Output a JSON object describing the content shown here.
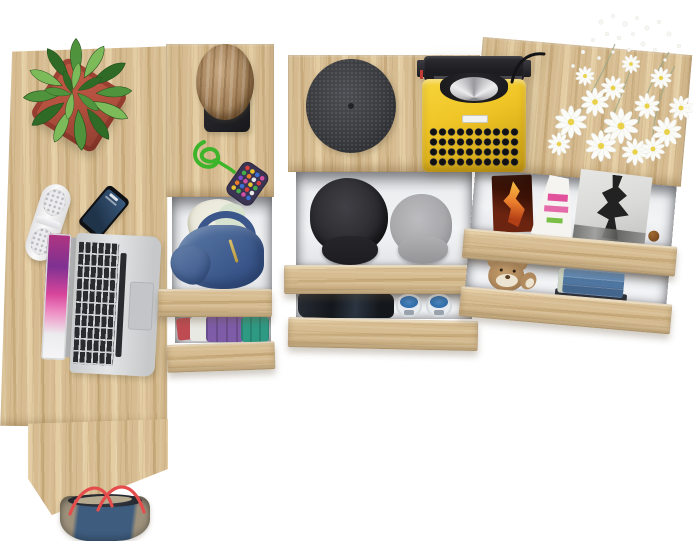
{
  "image_type": "Product photo — top-down view of a light-oak desk and three drawer chests with open drawers, staged with objects, on a white background",
  "background": "#ffffff",
  "colors": {
    "wood": "#d6bc90",
    "wood_light": "#e4cda3",
    "wood_dark": "#c8ab7c",
    "pot": "#b5523f",
    "pot_dark": "#8e3d2f",
    "leaf_dark": "#2f6a27",
    "leaf_mid": "#4f943c",
    "leaf_light": "#7cba5a",
    "cork": "#aa8154",
    "stand_black": "#232327",
    "cord_green": "#3eb42b",
    "pouch_base": "#3a3452",
    "flatcap": "#404146",
    "cap_black": "#2b2b2f",
    "cap_black_brim": "#1d1d21",
    "cap_gray": "#a9a9ac",
    "cap_gray_brim": "#949497",
    "tw_yellow": "#efc526",
    "tw_yellow_dark": "#c99f14",
    "tw_black": "#1d1d21",
    "laptop_key": "#2a2b2e",
    "screen_pink": "#d8459b",
    "screen_purple": "#7e3192",
    "screen_pink_light": "#ee8cc3",
    "phone_body": "#0e1014",
    "phone_screen_a": "#3a5a7e",
    "phone_screen_b": "#1f3349",
    "speaker_dot": "#b9babe",
    "hoodie_a": "#5b7aa6",
    "hoodie_b": "#3a568a",
    "shirt_cream": "#ebe9db",
    "shirt_mint": "#d7e3cf",
    "cl_purple": "#7e5ca8",
    "cl_teal": "#2f9a84",
    "cl_red": "#bf4b52",
    "cl_white": "#e9e9e3",
    "dark_cloth_a": "#272c34",
    "dark_cloth_b": "#14171c",
    "shoe_blue": "#2e6ba9",
    "shoe_white": "#e7eaee",
    "shoe_gray": "#9aa2ab",
    "fire_dark": "#3c1206",
    "fire_orange": "#ec7f2e",
    "fire_yellow": "#f6c344",
    "mag_white": "#f5f4f0",
    "mag_pink": "#e2519c",
    "mag_green": "#7abf45",
    "bw_bg": "#dadad8",
    "bw_fig": "#222222",
    "teddy": "#b18a5d",
    "teddy_cream": "#ece4d0",
    "jeans_a": "#6189b4",
    "jeans_b": "#44658c",
    "jeans_band": "#ccd3c3",
    "jeans_under": "#2e3138",
    "bag_denim": "#3e5c7e",
    "bag_taupe": "#9d917c",
    "bag_strap": "#e44d4c",
    "bag_inner": "#23262d",
    "bag_flap": "#b5aa8f",
    "daisy_white": "#fbfbf8",
    "daisy_center": "#e9d24a",
    "stem": "#9aa78a",
    "obj_shadow": "rgba(90,78,55,0.28)"
  },
  "furniture": {
    "finish": "light oak (sonoma)",
    "pieces": [
      {
        "id": "desk",
        "name": "desk",
        "position": "left"
      },
      {
        "id": "chest-left",
        "name": "narrow drawer chest",
        "position": "center-left",
        "open_drawers": 2
      },
      {
        "id": "chest-center",
        "name": "wide drawer chest",
        "position": "center",
        "open_drawers": 2
      },
      {
        "id": "chest-right",
        "name": "wide drawer chest",
        "position": "right",
        "open_drawers": 2
      }
    ]
  },
  "objects": {
    "plant": {
      "name": "green plant in red clay pot",
      "location": "desk top-left"
    },
    "speaker": {
      "name": "white portable pill speaker",
      "location": "desk left edge"
    },
    "phone": {
      "name": "black smartphone",
      "location": "desk"
    },
    "laptop": {
      "name": "open silver laptop with pink screen image",
      "location": "desk"
    },
    "stool": {
      "name": "cork stool on black stand",
      "location": "chest-left top"
    },
    "keychain": {
      "name": "green cord with multicolor beaded pouch",
      "location": "chest-left top"
    },
    "hoodie": {
      "name": "blue hoodie with cream shirt",
      "location": "chest-left upper drawer"
    },
    "folded_clothes": {
      "name": "folded red, white, purple and teal clothes",
      "location": "chest-left lower drawer"
    },
    "flat_cap": {
      "name": "charcoal tweed cap",
      "location": "chest-center top"
    },
    "typewriter": {
      "name": "yellow vintage typewriter",
      "location": "chest-center top right"
    },
    "cap_black": {
      "name": "black cadet cap",
      "location": "chest-center upper drawer"
    },
    "cap_gray": {
      "name": "gray cadet cap",
      "location": "chest-center upper drawer"
    },
    "dark_clothes": {
      "name": "folded dark clothes",
      "location": "chest-center lower drawer"
    },
    "sneakers": {
      "name": "pair of blue sneakers",
      "location": "chest-center lower drawer"
    },
    "flowers": {
      "name": "bouquet of white daisies",
      "location": "chest-right top"
    },
    "magazines": {
      "name": "three magazines: flame cover, pink-text cover, black-and-white fashion cover",
      "location": "chest-right upper drawer"
    },
    "teddy": {
      "name": "brown teddy bear",
      "location": "chest-right lower drawer"
    },
    "jeans": {
      "name": "stack of folded jeans",
      "location": "chest-right lower drawer"
    },
    "bag": {
      "name": "denim and taupe tote bag with red straps",
      "location": "below desk"
    }
  }
}
